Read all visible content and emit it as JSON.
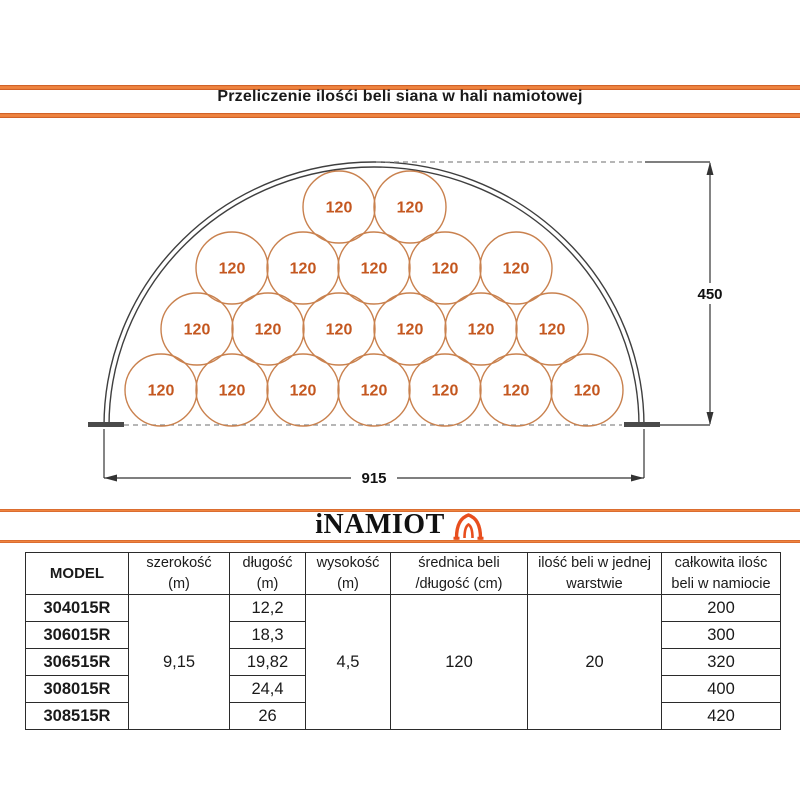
{
  "title": "Przeliczenie ilośći beli siana w hali namiotowej",
  "logo": {
    "text": "iNAMIOT",
    "icon": "tent-icon"
  },
  "colors": {
    "accent_orange": "#ef8440",
    "bale_stroke": "#c9814e",
    "bale_text": "#c4571f",
    "drawing_line": "#3f3f3f"
  },
  "diagram": {
    "bale_label": "120",
    "radius": 36,
    "rows": [
      {
        "y": 207,
        "xs": [
          339,
          410
        ]
      },
      {
        "y": 268,
        "xs": [
          232,
          303,
          374,
          445,
          516
        ]
      },
      {
        "y": 329,
        "xs": [
          197,
          268,
          339,
          410,
          481,
          552
        ]
      },
      {
        "y": 390,
        "xs": [
          161,
          232,
          303,
          374,
          445,
          516,
          587
        ]
      }
    ],
    "height_label": "450",
    "width_label": "915"
  },
  "table": {
    "headers": [
      {
        "line1": "MODEL",
        "line2": ""
      },
      {
        "line1": "szerokość",
        "line2": "(m)"
      },
      {
        "line1": "długość",
        "line2": "(m)"
      },
      {
        "line1": "wysokość",
        "line2": "(m)"
      },
      {
        "line1": "średnica beli",
        "line2": "/długość (cm)"
      },
      {
        "line1": "ilość beli w jednej",
        "line2": "warstwie"
      },
      {
        "line1": "całkowita ilośc",
        "line2": "beli w namiocie"
      }
    ],
    "merged": {
      "szerokosc": "9,15",
      "wysokosc": "4,5",
      "srednica": "120",
      "ilosc_warstwa": "20"
    },
    "rows": [
      {
        "model": "304015R",
        "dlugosc": "12,2",
        "total": "200"
      },
      {
        "model": "306015R",
        "dlugosc": "18,3",
        "total": "300"
      },
      {
        "model": "306515R",
        "dlugosc": "19,82",
        "total": "320"
      },
      {
        "model": "308015R",
        "dlugosc": "24,4",
        "total": "400"
      },
      {
        "model": "308515R",
        "dlugosc": "26",
        "total": "420"
      }
    ]
  }
}
